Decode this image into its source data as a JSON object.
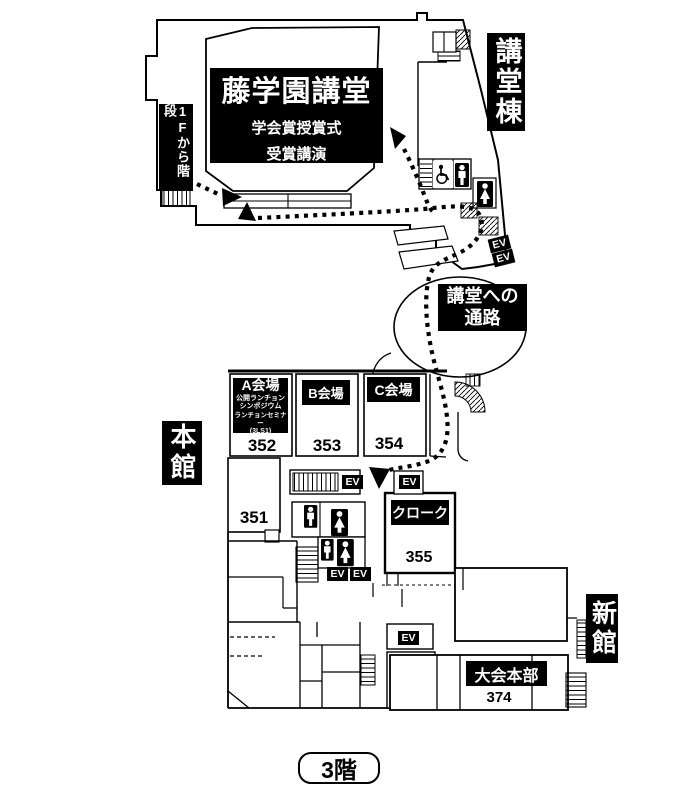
{
  "floor": {
    "label": "3階"
  },
  "wings": {
    "auditorium_wing": "講堂棟",
    "main_building": "本館",
    "new_building": "新館"
  },
  "auditorium": {
    "name": "藤学園講堂",
    "event_line1": "学会賞授賞式",
    "event_line2": "受賞講演"
  },
  "stairs_note": "1Fから階段",
  "passage": {
    "line1": "講堂への",
    "line2": "通路"
  },
  "halls": {
    "a": {
      "name": "A会場",
      "detail_line1": "公開ランチョン",
      "detail_line2": "シンポジウム",
      "detail_line3": "ランチョンセミナー",
      "detail_line4": "(3LS1)",
      "room_number": "352"
    },
    "b": {
      "name": "B会場",
      "room_number": "353"
    },
    "c": {
      "name": "C会場",
      "room_number": "354"
    }
  },
  "rooms": {
    "room_351": "351",
    "cloak": {
      "name": "クローク",
      "room_number": "355"
    },
    "headquarters": {
      "name": "大会本部",
      "room_number": "374"
    }
  },
  "elevator": {
    "label": "EV"
  }
}
